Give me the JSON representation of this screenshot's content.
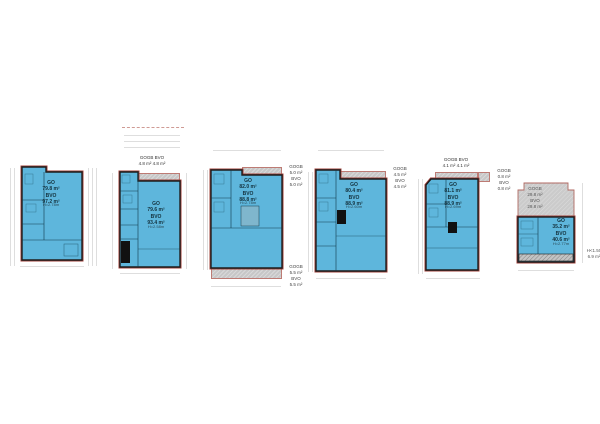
{
  "document_type": "floor-plan-sheet",
  "colors": {
    "room_fill": "#5EB6DC",
    "wall_outline": "#1d1d1d",
    "perimeter_line": "#a2403a",
    "hatch_fill": "#cbcbcb",
    "hatch_border": "#bd7b74",
    "dimension_line": "#dedede",
    "label_text": "#14323e"
  },
  "plans": [
    {
      "name": "floor-1",
      "area_label": "GO\n79.8 m²\nBVO\n97.2 m²",
      "height_note": "H=2.78m"
    },
    {
      "name": "floor-2",
      "top_annotation": "GOGB  BVO\n4.8 m²  4.8 m²",
      "area_label": "GO\n79.6 m²\nBVO\n93.4 m²",
      "height_note": "H=2.58m"
    },
    {
      "name": "floor-3",
      "right_top_annotation": "GOGB\n5.0 m²\nBVO\n5.0 m²",
      "right_bottom_annotation": "GOGB\n5.5 m²\nBVO\n5.5 m²",
      "area_label": "GO\n82.0 m²\nBVO\n88.8 m²",
      "height_note": "H=2.78m"
    },
    {
      "name": "floor-4",
      "right_top_annotation": "GOGB\n4.5 m²\nBVO\n4.5 m²",
      "area_label": "GO\n80.4 m²\nBVO\n88.9 m²",
      "height_note": "H=2.60m"
    },
    {
      "name": "floor-5",
      "top_annotation": "GOGB  BVO\n4.1 m²  4.1 m²",
      "right_top_annotation": "GOGB\n0.8 m²\nBVO\n0.8 m²",
      "area_label": "GO\n81.1 m²\nBVO\n88.9 m²",
      "height_note": "H=2.69m"
    },
    {
      "name": "floor-6",
      "roof_annotation": "GOGB\n29.8 m²\nBVO\n29.8 m²",
      "area_label": "GO\n35.2 m²\nBVO\n40.6 m²",
      "height_note": "H=2.77m",
      "side_note": "H<1.50\n6.9 m²"
    }
  ]
}
